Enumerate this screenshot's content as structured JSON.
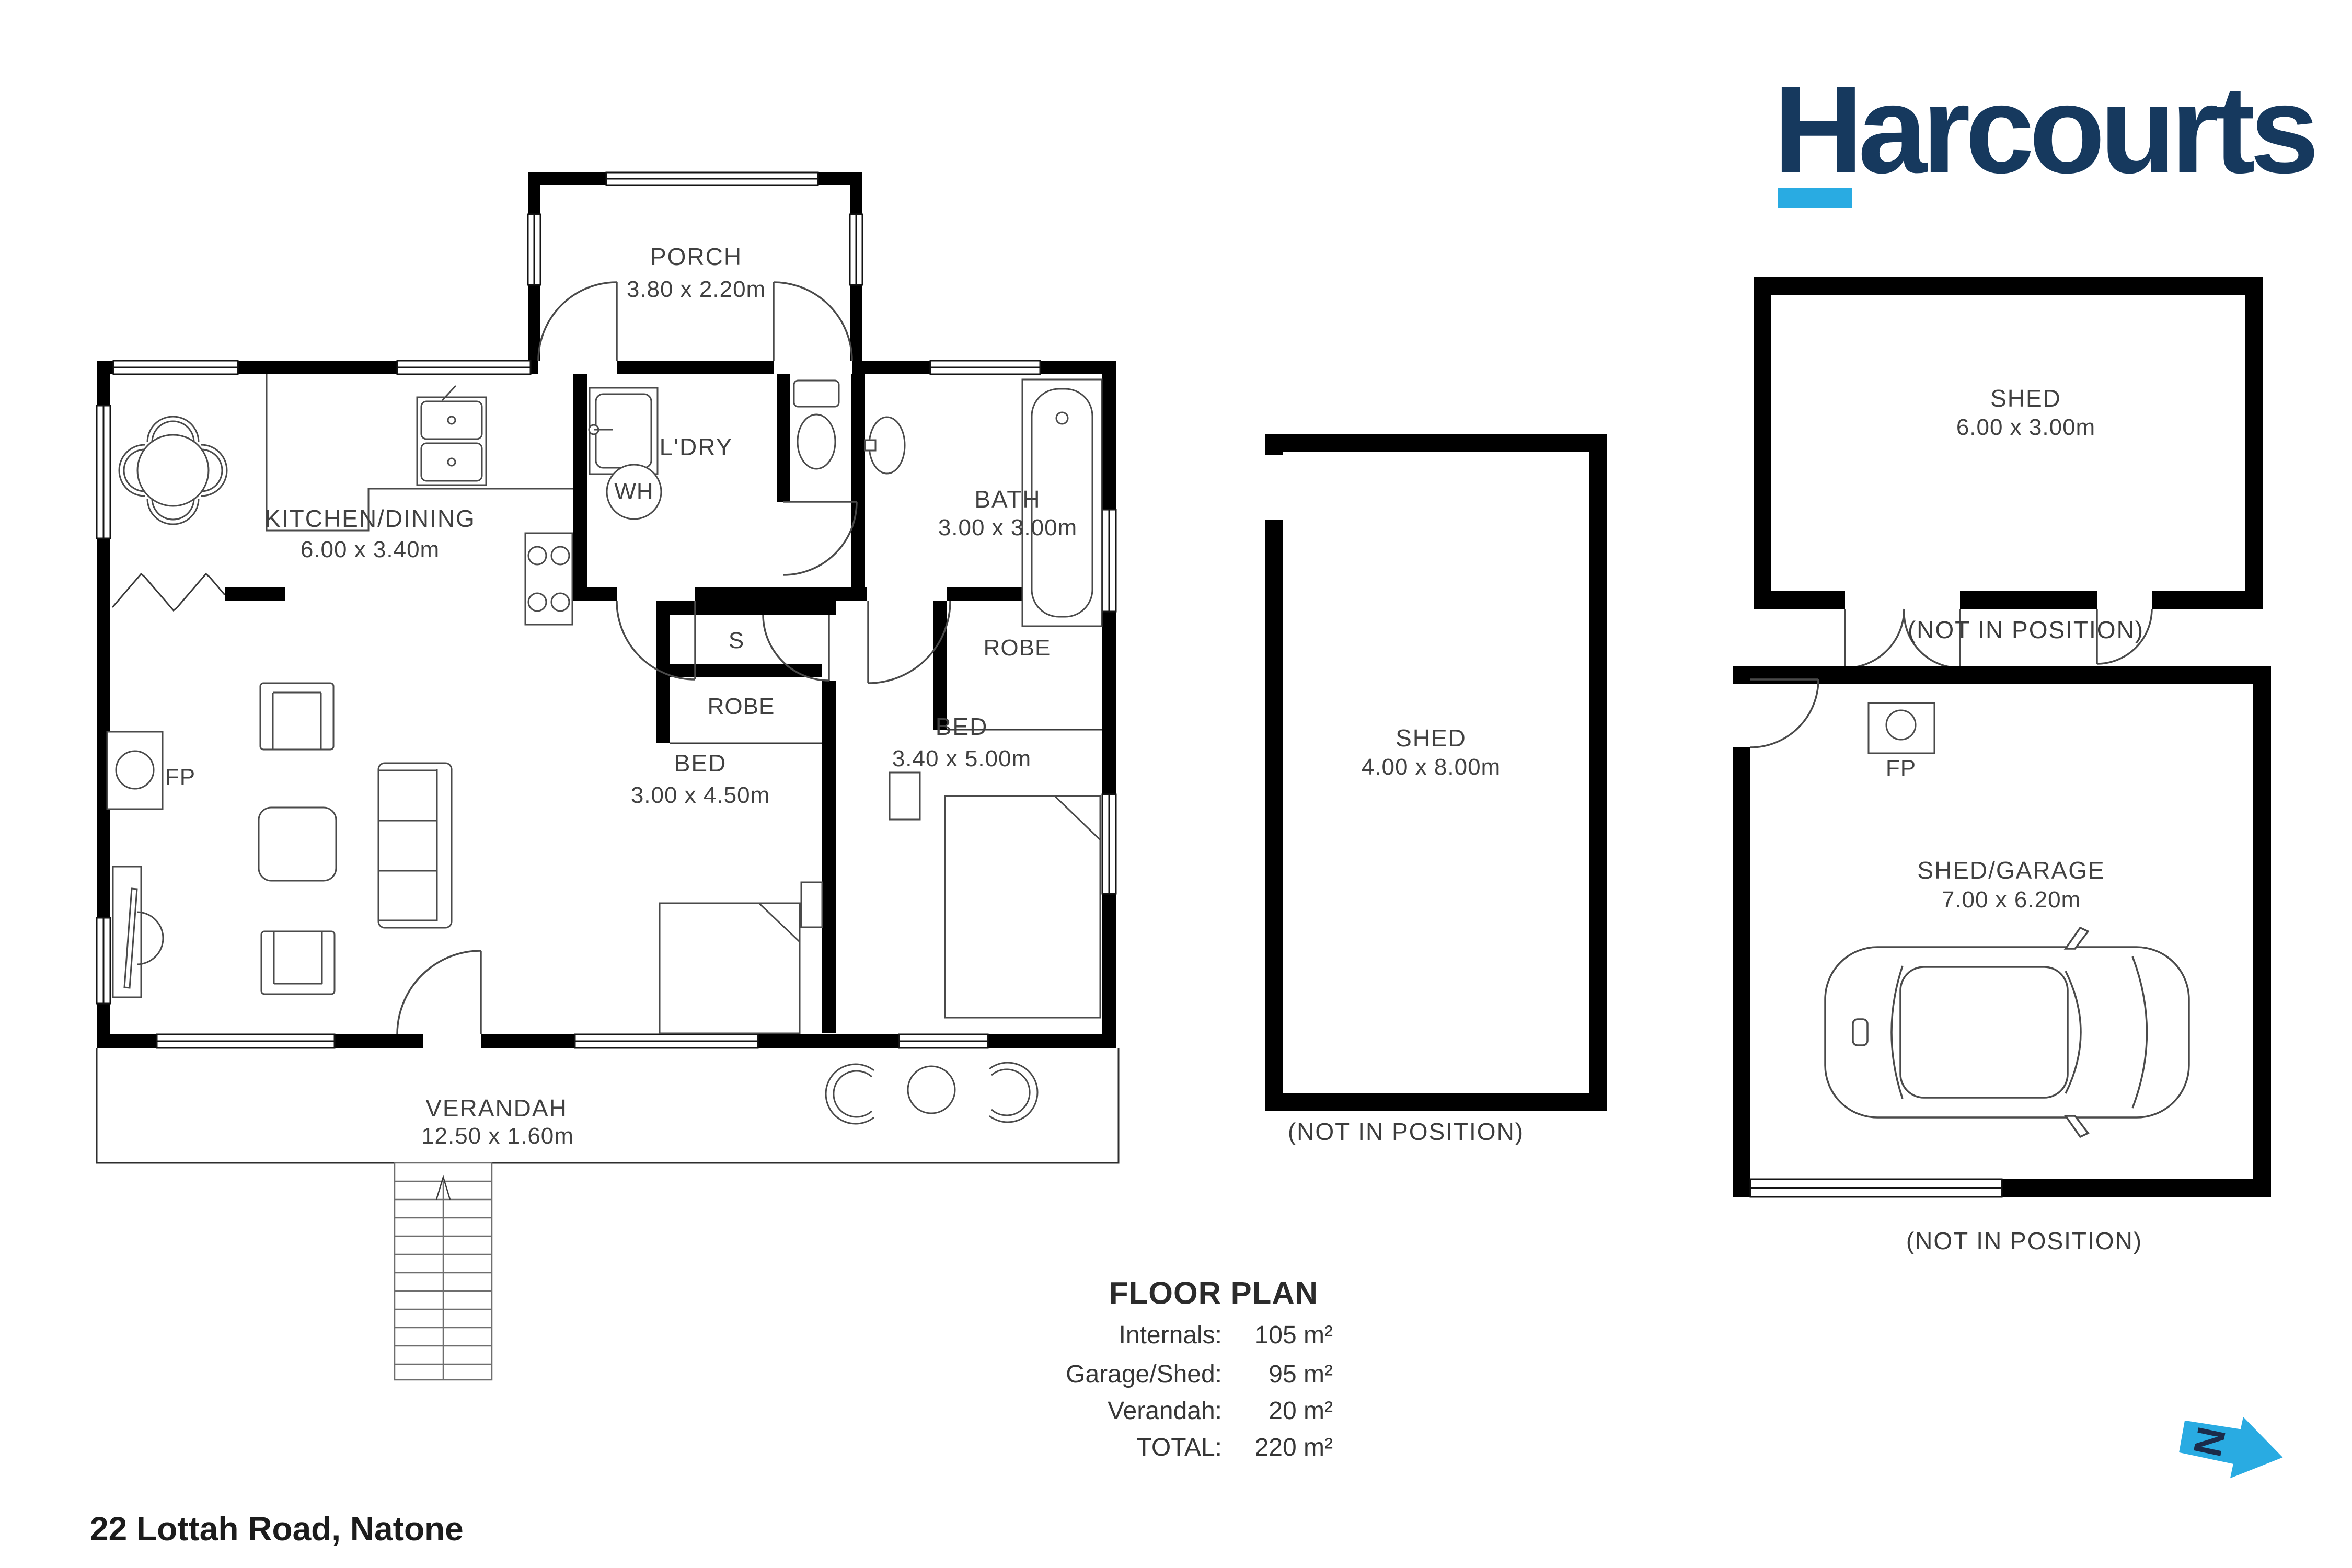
{
  "brand": {
    "name": "Harcourts",
    "navy": "#16395e",
    "cyan": "#29abe2"
  },
  "plan": {
    "house": {
      "porch": {
        "name": "PORCH",
        "dims": "3.80 x 2.20m"
      },
      "kitchen_dining": {
        "name": "KITCHEN/DINING",
        "dims": "6.00 x 3.40m"
      },
      "laundry": {
        "name": "L'DRY"
      },
      "water_heater": {
        "name": "WH"
      },
      "bath": {
        "name": "BATH",
        "dims": "3.00 x 3.00m"
      },
      "storage": {
        "name": "S"
      },
      "robe_bed1": {
        "name": "ROBE"
      },
      "robe_bed2": {
        "name": "ROBE"
      },
      "bed1": {
        "name": "BED",
        "dims": "3.00 x 4.50m"
      },
      "bed2": {
        "name": "BED",
        "dims": "3.40 x 5.00m"
      },
      "fireplace": {
        "name": "FP"
      },
      "verandah": {
        "name": "VERANDAH",
        "dims": "12.50 x 1.60m"
      }
    },
    "shed_middle": {
      "name": "SHED",
      "dims": "4.00 x 8.00m",
      "note": "(NOT IN POSITION)"
    },
    "shed_top_right": {
      "name": "SHED",
      "dims": "6.00 x 3.00m",
      "note": "(NOT IN POSITION)"
    },
    "garage": {
      "name": "SHED/GARAGE",
      "dims": "7.00 x 6.20m",
      "note": "(NOT IN POSITION)",
      "fireplace": "FP"
    }
  },
  "summary": {
    "title": "FLOOR PLAN",
    "rows": [
      {
        "label": "Internals:",
        "value": "105 m²"
      },
      {
        "label": "Garage/Shed:",
        "value": "95 m²"
      },
      {
        "label": "Verandah:",
        "value": "20 m²"
      },
      {
        "label": "TOTAL:",
        "value": "220 m²"
      }
    ]
  },
  "footer": {
    "address": "22 Lottah Road, Natone"
  },
  "north": {
    "letter": "N"
  }
}
